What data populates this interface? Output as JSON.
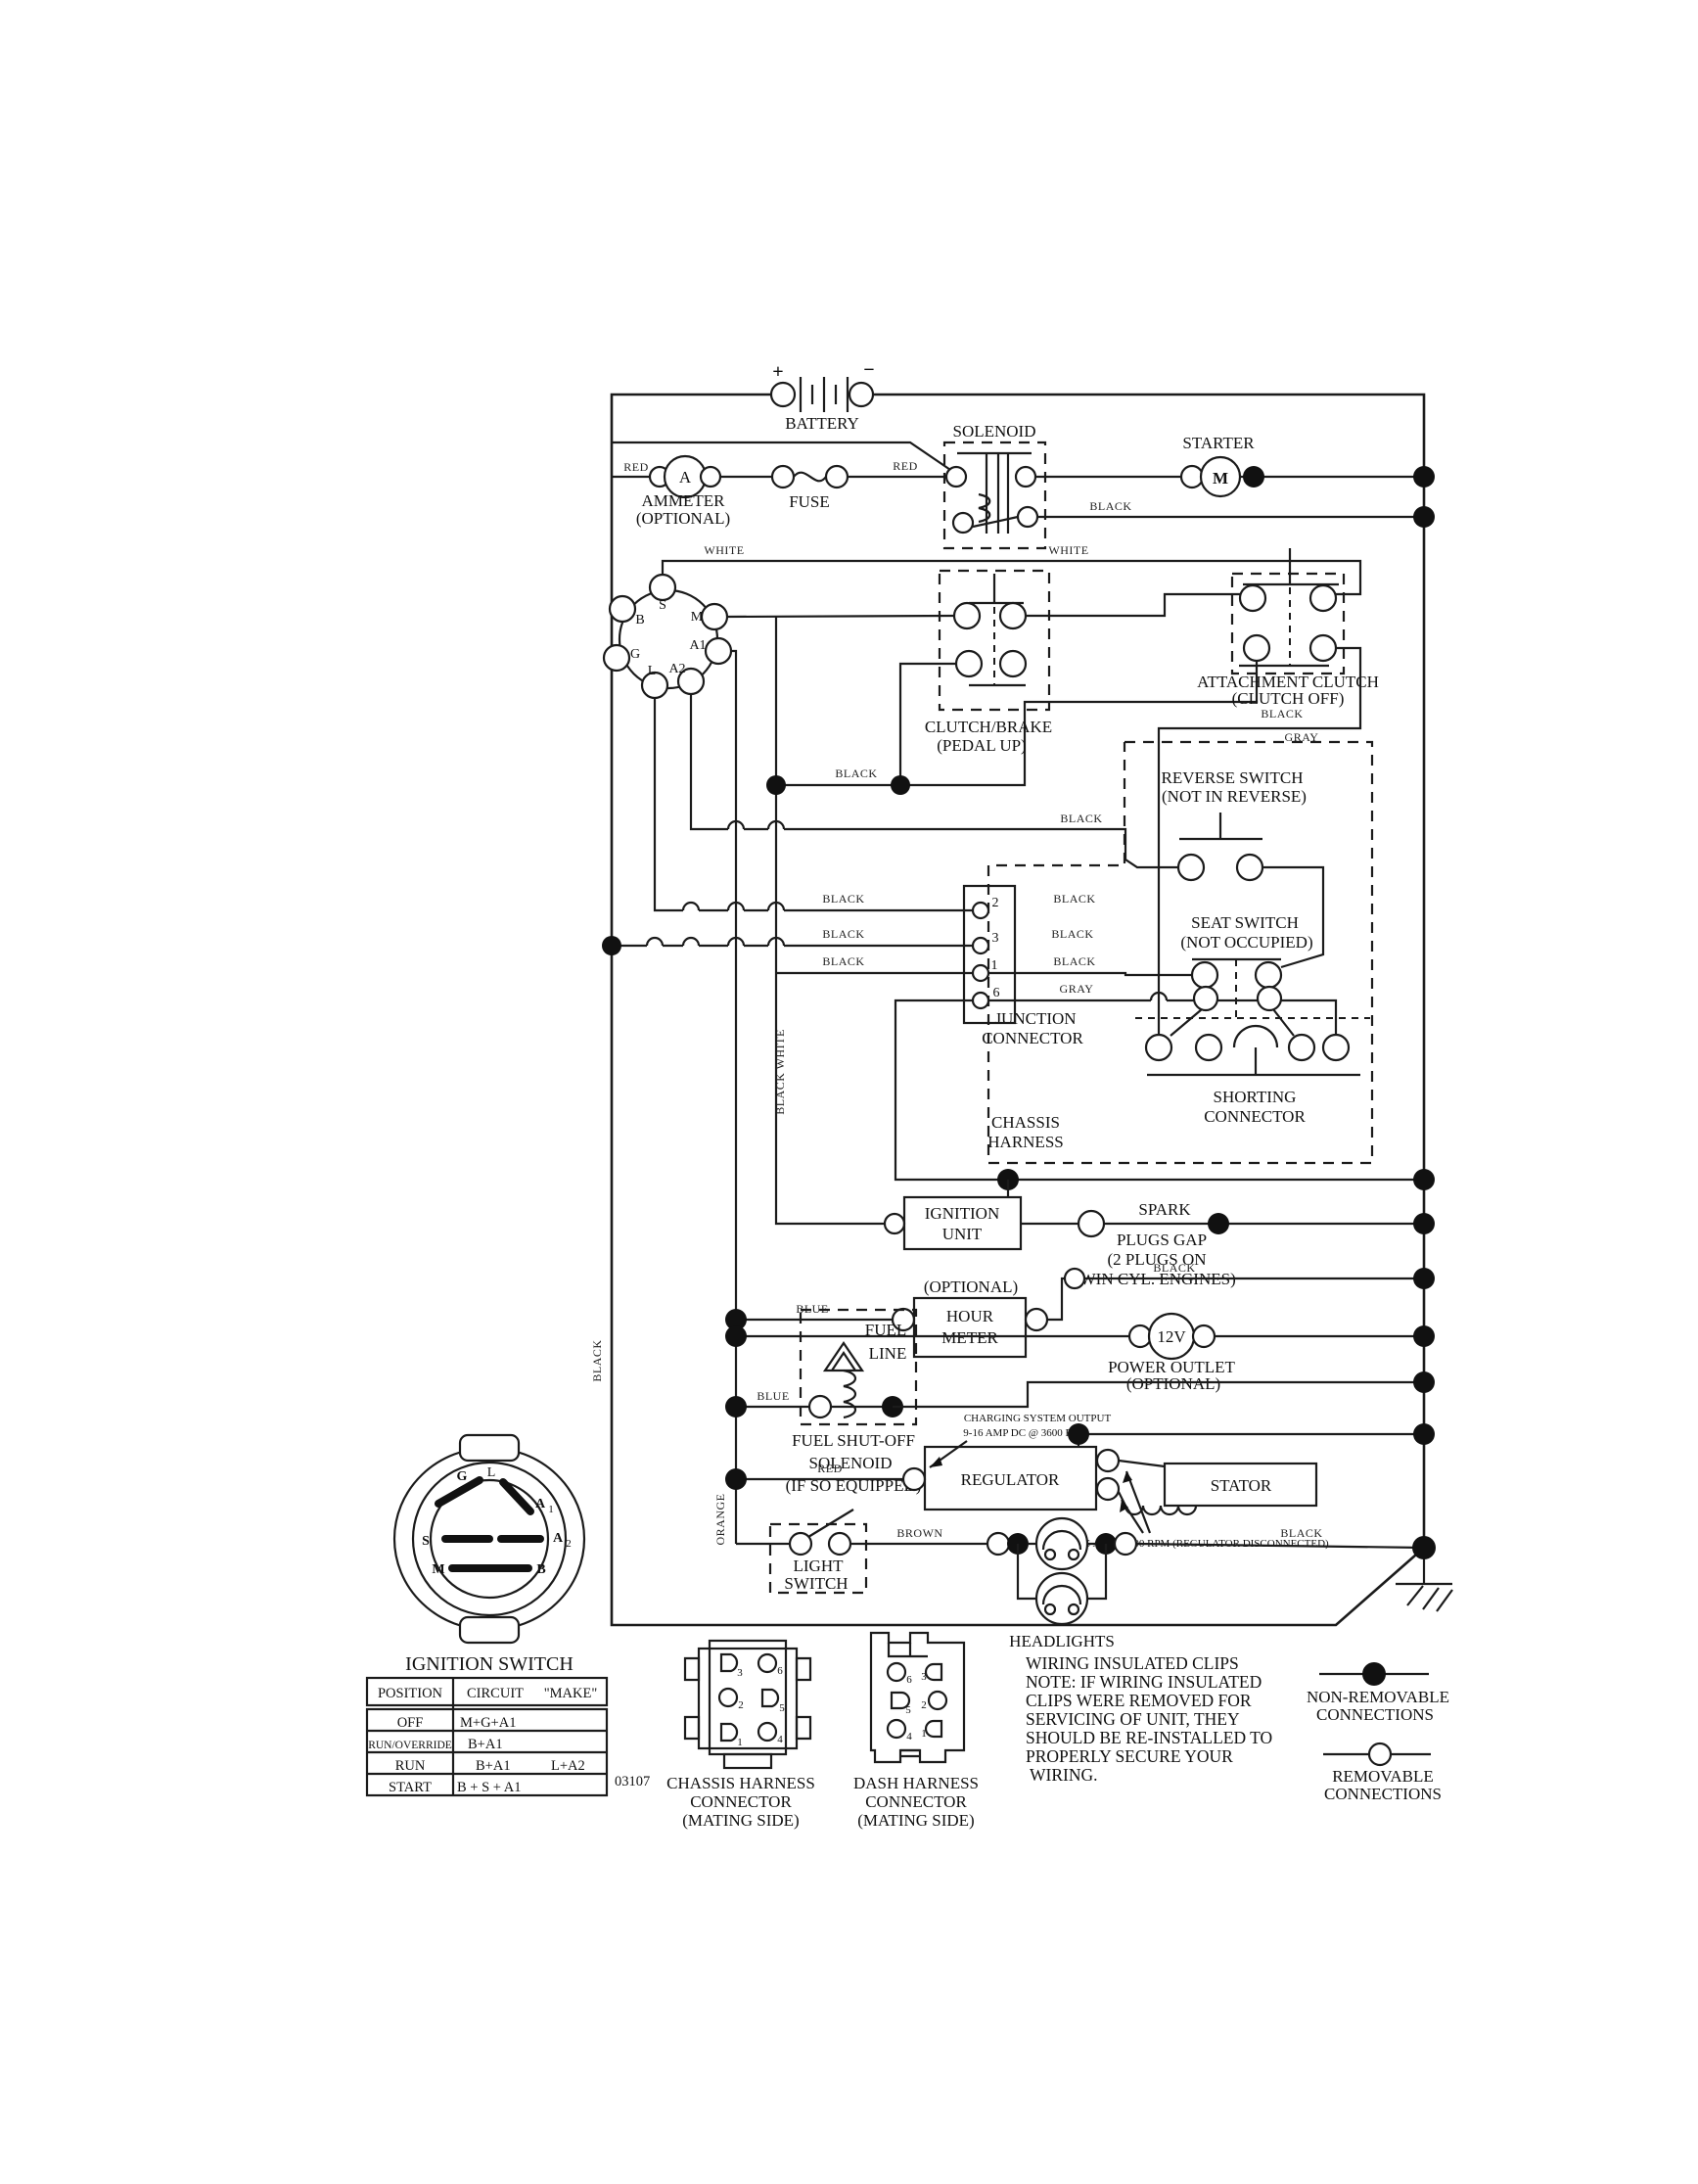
{
  "labels": {
    "battery": "BATTERY",
    "solenoid": "SOLENOID",
    "starter": "STARTER",
    "motor": "M",
    "ammeter": "AMMETER",
    "ammeter_opt": "(OPTIONAL)",
    "amp": "A",
    "fuse": "FUSE",
    "clutch_brake": "CLUTCH/BRAKE",
    "clutch_brake_sub": "(PEDAL UP)",
    "attachment": "ATTACHMENT CLUTCH",
    "attachment_sub": "(CLUTCH OFF)",
    "reverse": "REVERSE SWITCH",
    "reverse_sub": "(NOT IN REVERSE)",
    "seat": "SEAT SWITCH",
    "seat_sub": "(NOT OCCUPIED)",
    "junction": "JUNCTION",
    "junction2": "CONNECTOR",
    "shorting": "SHORTING",
    "shorting2": "CONNECTOR",
    "chassis": "CHASSIS",
    "chassis2": "HARNESS",
    "ignition_unit": "IGNITION",
    "ignition_unit2": "UNIT",
    "spark1": "SPARK",
    "spark2": "PLUGS GAP",
    "spark3": "(2 PLUGS ON",
    "spark4": "TWIN CYL. ENGINES)",
    "hour_opt": "(OPTIONAL)",
    "hour": "HOUR",
    "meter": "METER",
    "fuel": "FUEL",
    "line": "LINE",
    "fuel_shutoff1": "FUEL SHUT-OFF",
    "fuel_shutoff2": "SOLENOID",
    "fuel_shutoff3": "(IF SO EQUIPPED)",
    "v12": "12V",
    "power_outlet": "POWER OUTLET",
    "power_opt": "(OPTIONAL)",
    "charging1": "CHARGING SYSTEM OUTPUT",
    "charging2": "9-16 AMP DC @ 3600 RPM",
    "regulator": "REGULATOR",
    "stator": "STATOR",
    "volts28": "28 VOLTS AC @ 3600 RPM (REGULATOR DISCONNECTED)",
    "light": "LIGHT",
    "switch": "SWITCH",
    "headlights": "HEADLIGHTS",
    "ignition_switch": "IGNITION SWITCH",
    "code": "03107",
    "chassis_conn1": "CHASSIS HARNESS",
    "chassis_conn2": "CONNECTOR",
    "chassis_conn3": "(MATING SIDE)",
    "dash_conn1": "DASH HARNESS",
    "dash_conn2": "CONNECTOR",
    "dash_conn3": "(MATING SIDE)",
    "legend_nr1": "NON-REMOVABLE",
    "legend_nr2": "CONNECTIONS",
    "legend_r1": "REMOVABLE",
    "legend_r2": "CONNECTIONS",
    "plus": "+",
    "minus": "−"
  },
  "wires": {
    "red": "RED",
    "black": "BLACK",
    "white": "WHITE",
    "gray": "GRAY",
    "blue": "BLUE",
    "brown": "BROWN",
    "orange": "ORANGE",
    "black_white": "BLACK WHITE"
  },
  "cluster": {
    "s": "S",
    "m": "M",
    "a1": "A1",
    "a2": "A2",
    "l": "L",
    "g": "G",
    "b": "B"
  },
  "face": {
    "g": "G",
    "l": "L",
    "s": "S",
    "m": "M",
    "b": "B",
    "a": "A",
    "n1": "1",
    "n2": "2"
  },
  "junction_pins": {
    "p2": "2",
    "p3": "3",
    "p1": "1",
    "p6": "6"
  },
  "pins": {
    "n1": "1",
    "n2": "2",
    "n3": "3",
    "n4": "4",
    "n5": "5",
    "n6": "6"
  },
  "note": {
    "lines": [
      "WIRING INSULATED CLIPS",
      "NOTE:  IF WIRING INSULATED",
      "CLIPS WERE REMOVED FOR",
      "SERVICING OF UNIT, THEY",
      "SHOULD BE RE-INSTALLED TO",
      "PROPERLY SECURE YOUR",
      "WIRING."
    ]
  },
  "table": {
    "headers": {
      "position": "POSITION",
      "circuit": "CIRCUIT",
      "make": "\"MAKE\""
    },
    "rows": [
      {
        "position": "OFF",
        "circuit": "M+G+A1",
        "make": ""
      },
      {
        "position": "RUN/OVERRIDE",
        "circuit": "B+A1",
        "make": ""
      },
      {
        "position": "RUN",
        "circuit": "B+A1",
        "make": "L+A2"
      },
      {
        "position": "START",
        "circuit": "B + S + A1",
        "make": ""
      }
    ]
  }
}
